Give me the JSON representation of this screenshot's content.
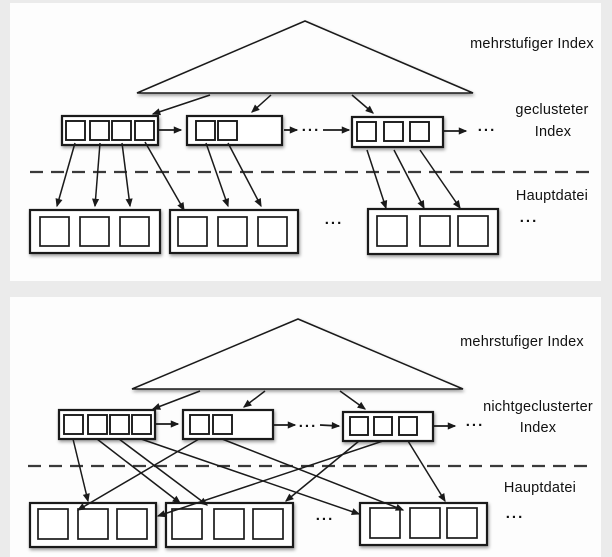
{
  "colors": {
    "background": "#ebebeb",
    "panel": "#fdfdfd",
    "line": "#1a1a1a",
    "text": "#101010"
  },
  "panels": [
    {
      "id": "clustered-index-diagram",
      "labels": [
        {
          "text": "mehrstufiger Index",
          "x": 532,
          "y": 44
        },
        {
          "text": "geclusteter",
          "x": 552,
          "y": 110
        },
        {
          "text": "Index",
          "x": 553,
          "y": 132
        },
        {
          "text": "Hauptdatei",
          "x": 552,
          "y": 196
        }
      ],
      "ellipses": [
        {
          "text": "...",
          "x": 311,
          "y": 129
        },
        {
          "text": "...",
          "x": 487,
          "y": 129
        },
        {
          "text": "...",
          "x": 334,
          "y": 222
        },
        {
          "text": "...",
          "x": 529,
          "y": 220
        }
      ],
      "triangle": {
        "apex_x": 305,
        "apex_y": 21,
        "base_y": 93,
        "left_x": 137,
        "right_x": 473
      },
      "triangle_arrows": [
        [
          210,
          95,
          153,
          114
        ],
        [
          271,
          95,
          252,
          112
        ],
        [
          352,
          95,
          373,
          113
        ]
      ],
      "index_blocks": [
        {
          "x": 62,
          "y": 116,
          "w": 96,
          "h": 29,
          "sq": 19,
          "squares": [
            [
              66,
              121
            ],
            [
              90,
              121
            ],
            [
              112,
              121
            ],
            [
              135,
              121
            ]
          ]
        },
        {
          "x": 187,
          "y": 116,
          "w": 95,
          "h": 29,
          "sq": 19,
          "squares": [
            [
              196,
              121
            ],
            [
              218,
              121
            ]
          ]
        },
        {
          "x": 352,
          "y": 117,
          "w": 91,
          "h": 30,
          "sq": 19,
          "squares": [
            [
              357,
              122
            ],
            [
              384,
              122
            ],
            [
              410,
              122
            ]
          ]
        }
      ],
      "data_blocks": [
        {
          "x": 30,
          "y": 210,
          "w": 130,
          "h": 43,
          "sq": 29,
          "squares": [
            [
              40,
              217
            ],
            [
              80,
              217
            ],
            [
              120,
              217
            ]
          ]
        },
        {
          "x": 170,
          "y": 210,
          "w": 128,
          "h": 43,
          "sq": 29,
          "squares": [
            [
              178,
              217
            ],
            [
              218,
              217
            ],
            [
              258,
              217
            ]
          ]
        },
        {
          "x": 368,
          "y": 209,
          "w": 130,
          "h": 45,
          "sq": 30,
          "squares": [
            [
              377,
              216
            ],
            [
              420,
              216
            ],
            [
              458,
              216
            ]
          ]
        }
      ],
      "chain_arrows": [
        [
          158,
          130,
          181,
          130
        ],
        [
          284,
          130,
          297,
          130
        ],
        [
          323,
          130,
          349,
          130
        ],
        [
          443,
          131,
          466,
          131
        ]
      ],
      "entry_arrows": [
        [
          75,
          143,
          57,
          206
        ],
        [
          100,
          143,
          95,
          206
        ],
        [
          122,
          143,
          130,
          206
        ],
        [
          145,
          142,
          184,
          210
        ],
        [
          206,
          143,
          228,
          206
        ],
        [
          228,
          143,
          261,
          206
        ],
        [
          367,
          150,
          386,
          208
        ],
        [
          394,
          150,
          424,
          208
        ],
        [
          420,
          150,
          460,
          208
        ]
      ],
      "dashed_line": {
        "y": 172,
        "x1": 30,
        "x2": 597
      }
    },
    {
      "id": "nonclustered-index-diagram",
      "labels": [
        {
          "text": "mehrstufiger Index",
          "x": 522,
          "y": 342
        },
        {
          "text": "nichtgeclusterter",
          "x": 538,
          "y": 407
        },
        {
          "text": "Index",
          "x": 538,
          "y": 428
        },
        {
          "text": "Hauptdatei",
          "x": 540,
          "y": 488
        }
      ],
      "ellipses": [
        {
          "text": "...",
          "x": 308,
          "y": 425
        },
        {
          "text": "...",
          "x": 475,
          "y": 424
        },
        {
          "text": "...",
          "x": 325,
          "y": 518
        },
        {
          "text": "...",
          "x": 515,
          "y": 516
        }
      ],
      "triangle": {
        "apex_x": 298,
        "apex_y": 319,
        "base_y": 389,
        "left_x": 132,
        "right_x": 463
      },
      "triangle_arrows": [
        [
          200,
          391,
          153,
          409
        ],
        [
          265,
          391,
          244,
          407
        ],
        [
          340,
          391,
          365,
          409
        ]
      ],
      "index_blocks": [
        {
          "x": 59,
          "y": 410,
          "w": 96,
          "h": 29,
          "sq": 19,
          "squares": [
            [
              64,
              415
            ],
            [
              88,
              415
            ],
            [
              110,
              415
            ],
            [
              132,
              415
            ]
          ]
        },
        {
          "x": 183,
          "y": 410,
          "w": 90,
          "h": 29,
          "sq": 19,
          "squares": [
            [
              190,
              415
            ],
            [
              213,
              415
            ]
          ]
        },
        {
          "x": 343,
          "y": 412,
          "w": 90,
          "h": 29,
          "sq": 18,
          "squares": [
            [
              350,
              417
            ],
            [
              374,
              417
            ],
            [
              399,
              417
            ]
          ]
        }
      ],
      "data_blocks": [
        {
          "x": 30,
          "y": 503,
          "w": 126,
          "h": 44,
          "sq": 30,
          "squares": [
            [
              38,
              509
            ],
            [
              78,
              509
            ],
            [
              117,
              509
            ]
          ]
        },
        {
          "x": 166,
          "y": 503,
          "w": 127,
          "h": 44,
          "sq": 30,
          "squares": [
            [
              172,
              509
            ],
            [
              214,
              509
            ],
            [
              253,
              509
            ]
          ]
        },
        {
          "x": 360,
          "y": 503,
          "w": 127,
          "h": 42,
          "sq": 30,
          "squares": [
            [
              370,
              508
            ],
            [
              410,
              508
            ],
            [
              447,
              508
            ]
          ]
        }
      ],
      "chain_arrows": [
        [
          155,
          424,
          178,
          424
        ],
        [
          273,
          425,
          295,
          425
        ],
        [
          320,
          425,
          339,
          426
        ],
        [
          433,
          426,
          455,
          426
        ]
      ],
      "entry_arrows": [
        [
          73,
          439,
          88,
          501
        ],
        [
          97,
          439,
          180,
          503
        ],
        [
          119,
          439,
          207,
          505
        ],
        [
          141,
          439,
          359,
          514
        ],
        [
          199,
          439,
          78,
          510
        ],
        [
          222,
          439,
          403,
          510
        ],
        [
          359,
          441,
          286,
          501
        ],
        [
          383,
          441,
          158,
          516
        ],
        [
          408,
          441,
          445,
          501
        ]
      ],
      "dashed_line": {
        "y": 466,
        "x1": 28,
        "x2": 595
      }
    }
  ]
}
